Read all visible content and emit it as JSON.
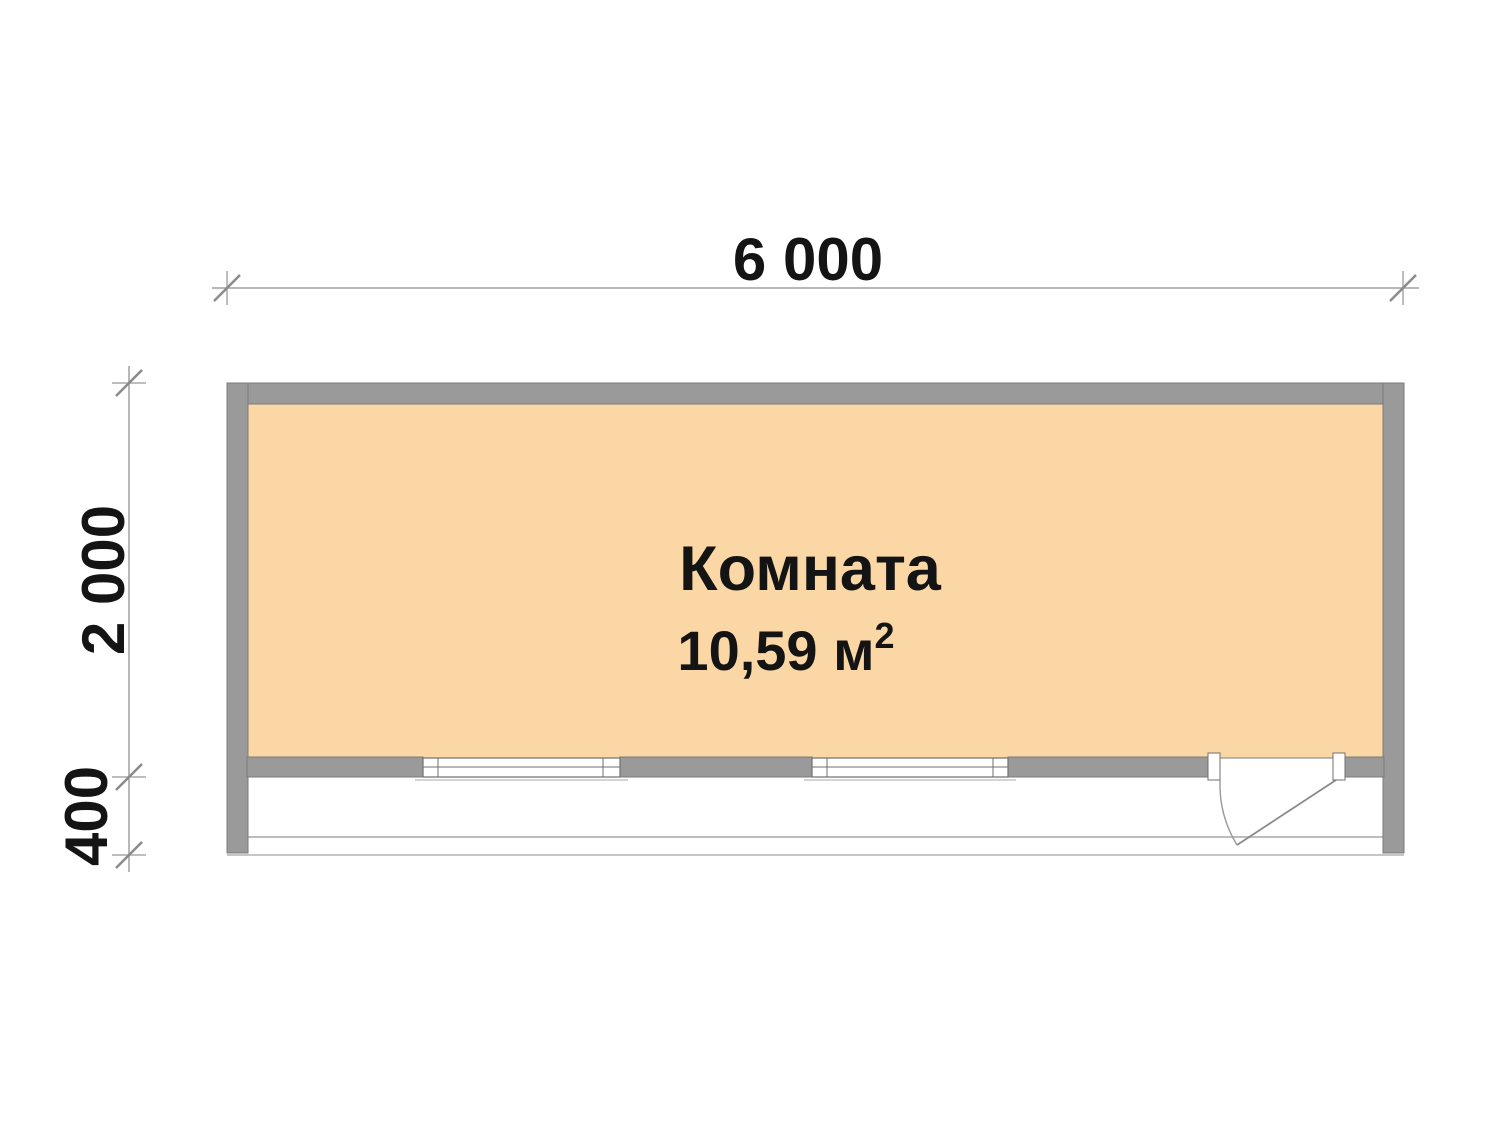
{
  "dimensions": {
    "width": "6 000",
    "height": "2 000",
    "porch_depth": "400"
  },
  "room": {
    "name": "Комната",
    "area": "10,59 м",
    "area_exponent": "2"
  },
  "colors": {
    "floor_fill": "#fbd7a5",
    "wall_fill": "#9a9a9a",
    "wall_outline": "#7b7b7b",
    "window_outline": "#6f6f6f",
    "dimension_line": "#a0a0a0",
    "dimension_tick": "#8a8a8a",
    "porch_line": "#bdbdbd",
    "door_line": "#8a8a8a",
    "label_text": "#141414"
  }
}
